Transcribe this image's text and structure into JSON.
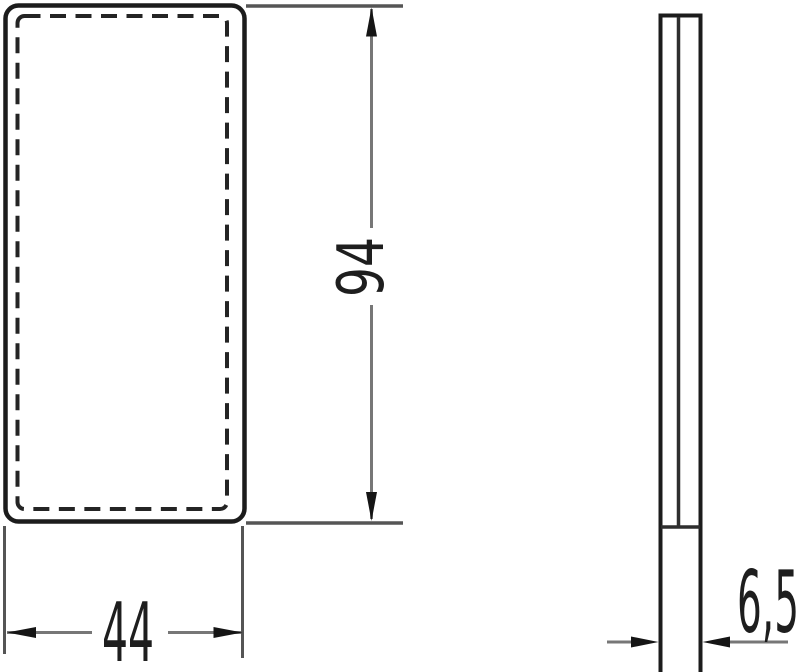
{
  "drawing": {
    "kind": "dimensioned-technical-drawing",
    "dimensions": {
      "width": {
        "label": "44"
      },
      "height": {
        "label": "94"
      },
      "depth": {
        "label": "6,5"
      }
    },
    "colors": {
      "background": "#ffffff",
      "object_line": "#1c1c1c",
      "hidden_dash_line": "#242424",
      "extension_line": "#555555",
      "dimension_line": "#777777",
      "arrowhead": "#151515",
      "text": "#1e1e1e"
    }
  }
}
